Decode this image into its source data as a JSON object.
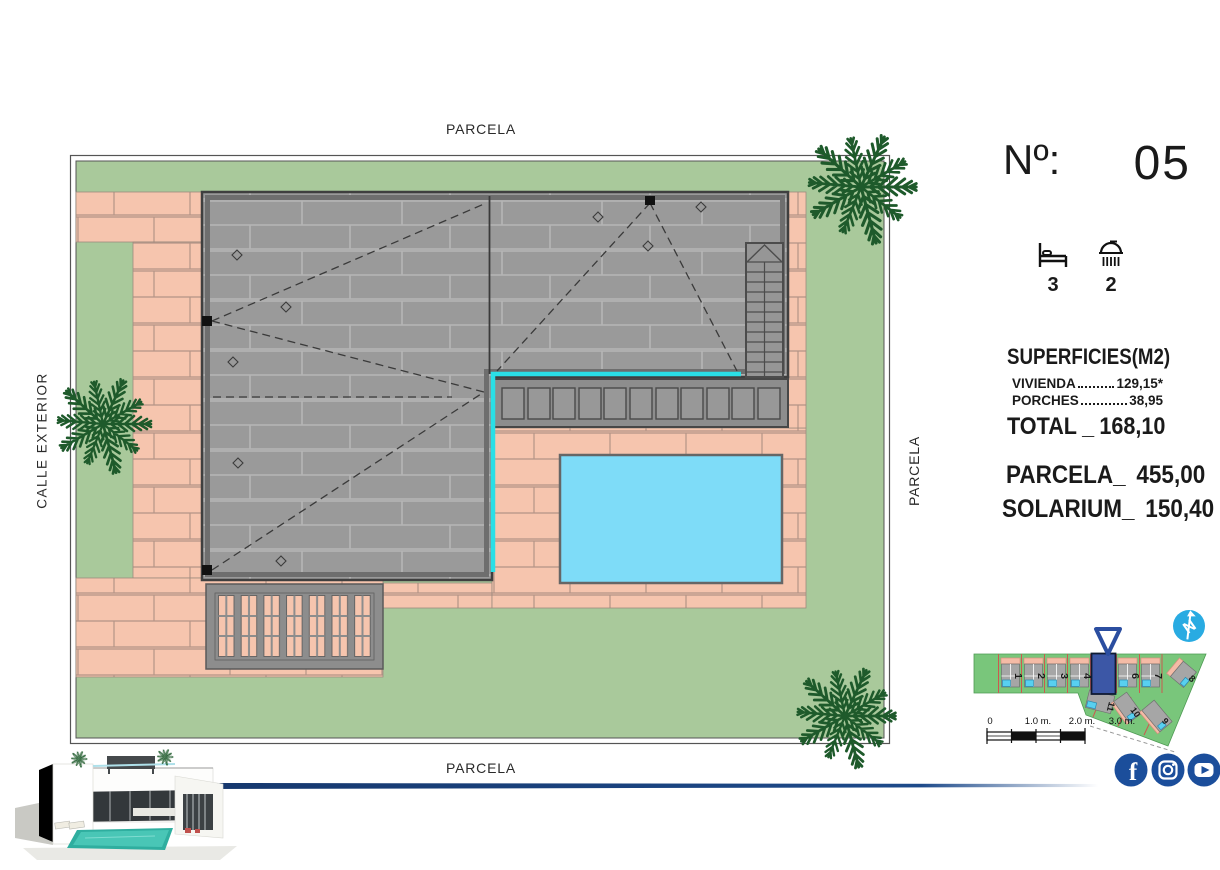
{
  "plan": {
    "labels": {
      "top": "PARCELA",
      "bottom": "PARCELA",
      "right": "PARCELA",
      "left": "CALLE EXTERIOR"
    },
    "colors": {
      "lawn": "#a9c99b",
      "paving": "#f6c5ae",
      "roof": "#9a9a9a",
      "pool": "#7edcf8",
      "solarium_edge": "#2adfe6",
      "palm": "#1e5a2b"
    }
  },
  "panel": {
    "number_label": "Nº:",
    "number_value": "05",
    "bedrooms": "3",
    "bathrooms": "2",
    "areas_title": "SUPERFICIES(M2)",
    "rows": [
      {
        "label": "VIVIENDA",
        "value": "129,15*"
      },
      {
        "label": "PORCHES",
        "value": "38,95"
      }
    ],
    "total": {
      "label": "TOTAL",
      "separator": "_",
      "value": "168,10"
    },
    "parcela": {
      "label": "PARCELA_",
      "value": "455,00"
    },
    "solarium": {
      "label": "SOLARIUM_",
      "value": "150,40"
    }
  },
  "minimap": {
    "plot_labels": [
      "1",
      "2",
      "3",
      "4",
      "6",
      "7",
      "8",
      "9",
      "10",
      "11"
    ],
    "north_letter": "N",
    "land_color": "#79c67b",
    "highlight_color": "#3c57a6",
    "marker_color": "#2b4ea0",
    "circle_color": "#29abe2"
  },
  "scalebar": {
    "labels": [
      "0",
      "1.0 m.",
      "2.0 m.",
      "3.0 m."
    ]
  },
  "social": {
    "facebook_glyph": "f",
    "brand_color": "#1b4e9b"
  },
  "divider_color": "#16386e"
}
